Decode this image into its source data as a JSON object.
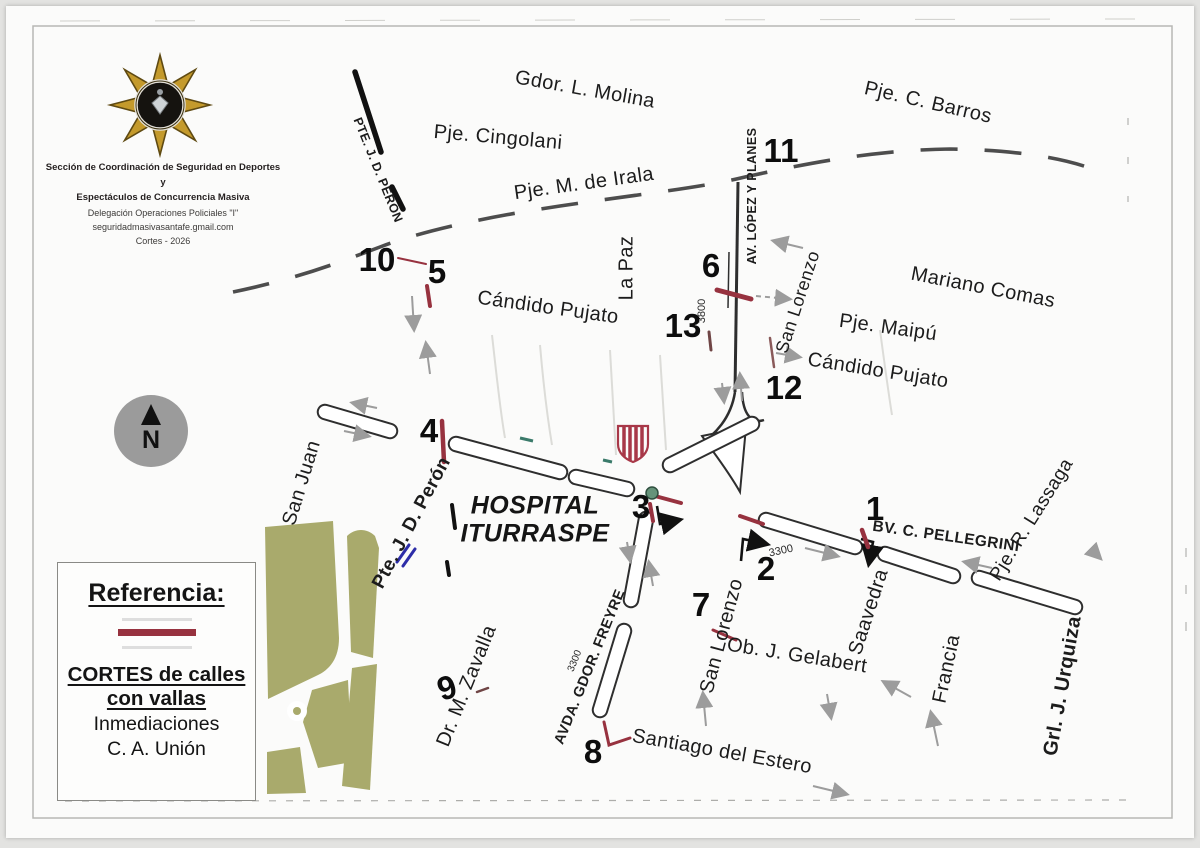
{
  "page": {
    "org_block": {
      "badge_icon": "police-star-badge",
      "line1": "Sección de Coordinación de Seguridad en Deportes y",
      "line2": "Espectáculos de Concurrencia Masiva",
      "line3": "Delegación Operaciones Policiales \"I\"",
      "line4": "seguridadmasivasantafe.gmail.com",
      "line5": "Cortes - 2026"
    },
    "compass": {
      "label": "N"
    },
    "hospital": {
      "line1": "HOSPITAL",
      "line2": "ITURRASPE"
    },
    "legend": {
      "title": "Referencia:",
      "symbol": "red-barrier-line",
      "line1": "CORTES de calles",
      "line2": "con vallas",
      "line3": "Inmediaciones",
      "line4": "C. A. Unión"
    },
    "colors": {
      "barrier_red": "#97323f",
      "park_green": "#a9aa6c",
      "arrow_gray": "#9c9c9c",
      "boundary_dash": "#4d4d4d",
      "junction_dot_green": "#66937a",
      "bridge_mark_blue": "#2d2da8",
      "badge_gold": "#c49a2c"
    },
    "streets": [
      {
        "id": "gdor-l-molina",
        "label": "Gdor. L. Molina",
        "x": 585,
        "y": 90,
        "rot": 10,
        "size": 20,
        "bold": false
      },
      {
        "id": "pje-cingolani",
        "label": "Pje. Cingolani",
        "x": 498,
        "y": 138,
        "rot": 5,
        "size": 20,
        "bold": false
      },
      {
        "id": "pje-m-de-irala",
        "label": "Pje. M. de Irala",
        "x": 584,
        "y": 184,
        "rot": -8,
        "size": 20,
        "bold": false
      },
      {
        "id": "pje-c-barros",
        "label": "Pje. C. Barros",
        "x": 928,
        "y": 103,
        "rot": 13,
        "size": 20,
        "bold": false
      },
      {
        "id": "av-lopez-y-planes",
        "label": "AV. LÓPEZ Y PLANES",
        "x": 752,
        "y": 196,
        "rot": -90,
        "size": 12.5,
        "bold": true
      },
      {
        "id": "san-lorenzo-north",
        "label": "San Lorenzo",
        "x": 798,
        "y": 302,
        "rot": -72,
        "size": 18,
        "bold": false
      },
      {
        "id": "mariano-comas",
        "label": "Mariano Comas",
        "x": 983,
        "y": 288,
        "rot": 11,
        "size": 20,
        "bold": false
      },
      {
        "id": "pje-maipu",
        "label": "Pje. Maipú",
        "x": 888,
        "y": 328,
        "rot": 8,
        "size": 20,
        "bold": false
      },
      {
        "id": "candido-pujato-east",
        "label": "Cándido Pujato",
        "x": 878,
        "y": 371,
        "rot": 9,
        "size": 20,
        "bold": false
      },
      {
        "id": "la-paz",
        "label": "La Paz",
        "x": 627,
        "y": 268,
        "rot": -90,
        "size": 20,
        "bold": false
      },
      {
        "id": "candido-pujato-west",
        "label": "Cándido Pujato",
        "x": 548,
        "y": 308,
        "rot": 8,
        "size": 20,
        "bold": false
      },
      {
        "id": "pte-jd-peron-north",
        "label": "PTE. J. D. PERÓN",
        "x": 378,
        "y": 170,
        "rot": 68,
        "size": 12.5,
        "bold": true
      },
      {
        "id": "san-juan",
        "label": "San Juan",
        "x": 302,
        "y": 483,
        "rot": -73,
        "size": 20,
        "bold": false
      },
      {
        "id": "pte-jd-peron-south",
        "label": "Pte. J. D. Perón",
        "x": 412,
        "y": 523,
        "rot": -62,
        "size": 19,
        "bold": true
      },
      {
        "id": "bv-c-pellegrini",
        "label": "BV. C. PELLEGRINI",
        "x": 946,
        "y": 537,
        "rot": 8,
        "size": 15.5,
        "bold": true
      },
      {
        "id": "pje-r-lassaga",
        "label": "Pje. R. Lassaga",
        "x": 1032,
        "y": 520,
        "rot": -58,
        "size": 19,
        "bold": false
      },
      {
        "id": "saavedra",
        "label": "Saavedra",
        "x": 869,
        "y": 612,
        "rot": -72,
        "size": 20,
        "bold": false
      },
      {
        "id": "san-lorenzo-south",
        "label": "San Lorenzo",
        "x": 722,
        "y": 636,
        "rot": -75,
        "size": 20,
        "bold": false
      },
      {
        "id": "ob-j-gelabert",
        "label": "Ob. J. Gelabert",
        "x": 797,
        "y": 656,
        "rot": 9,
        "size": 20,
        "bold": false
      },
      {
        "id": "francia",
        "label": "Francia",
        "x": 947,
        "y": 669,
        "rot": -78,
        "size": 20,
        "bold": false
      },
      {
        "id": "grl-j-urquiza",
        "label": "Grl. J. Urquiza",
        "x": 1063,
        "y": 686,
        "rot": -80,
        "size": 20,
        "bold": true
      },
      {
        "id": "avda-gdor-freyre",
        "label": "AVDA. GDOR. FREYRE",
        "x": 590,
        "y": 667,
        "rot": -68,
        "size": 14.5,
        "bold": true
      },
      {
        "id": "dr-m-zavalla",
        "label": "Dr. M. Zavalla",
        "x": 467,
        "y": 686,
        "rot": -68,
        "size": 20,
        "bold": false
      },
      {
        "id": "santiago-del-estero",
        "label": "Santiago del Estero",
        "x": 722,
        "y": 752,
        "rot": 10,
        "size": 20,
        "bold": false
      }
    ],
    "block_numbers": [
      {
        "label": "3800",
        "x": 702,
        "y": 311,
        "rot": -90,
        "size": 11
      },
      {
        "label": "3300",
        "x": 781,
        "y": 551,
        "rot": -12,
        "size": 11
      },
      {
        "label": "3300",
        "x": 575,
        "y": 661,
        "rot": -68,
        "size": 10
      }
    ],
    "closure_points": [
      {
        "num": "1",
        "x": 875,
        "y": 509,
        "rot": 0
      },
      {
        "num": "2",
        "x": 766,
        "y": 569,
        "rot": 0
      },
      {
        "num": "3",
        "x": 641,
        "y": 507,
        "rot": 0
      },
      {
        "num": "4",
        "x": 429,
        "y": 431,
        "rot": 0
      },
      {
        "num": "5",
        "x": 437,
        "y": 272,
        "rot": 0
      },
      {
        "num": "6",
        "x": 711,
        "y": 266,
        "rot": 0
      },
      {
        "num": "7",
        "x": 701,
        "y": 605,
        "rot": 0
      },
      {
        "num": "8",
        "x": 593,
        "y": 752,
        "rot": 0
      },
      {
        "num": "9",
        "x": 447,
        "y": 688,
        "rot": -18
      },
      {
        "num": "10",
        "x": 377,
        "y": 260,
        "rot": 0
      },
      {
        "num": "11",
        "x": 781,
        "y": 151,
        "rot": 0
      },
      {
        "num": "12",
        "x": 784,
        "y": 388,
        "rot": 0
      },
      {
        "num": "13",
        "x": 683,
        "y": 326,
        "rot": 0
      }
    ]
  }
}
